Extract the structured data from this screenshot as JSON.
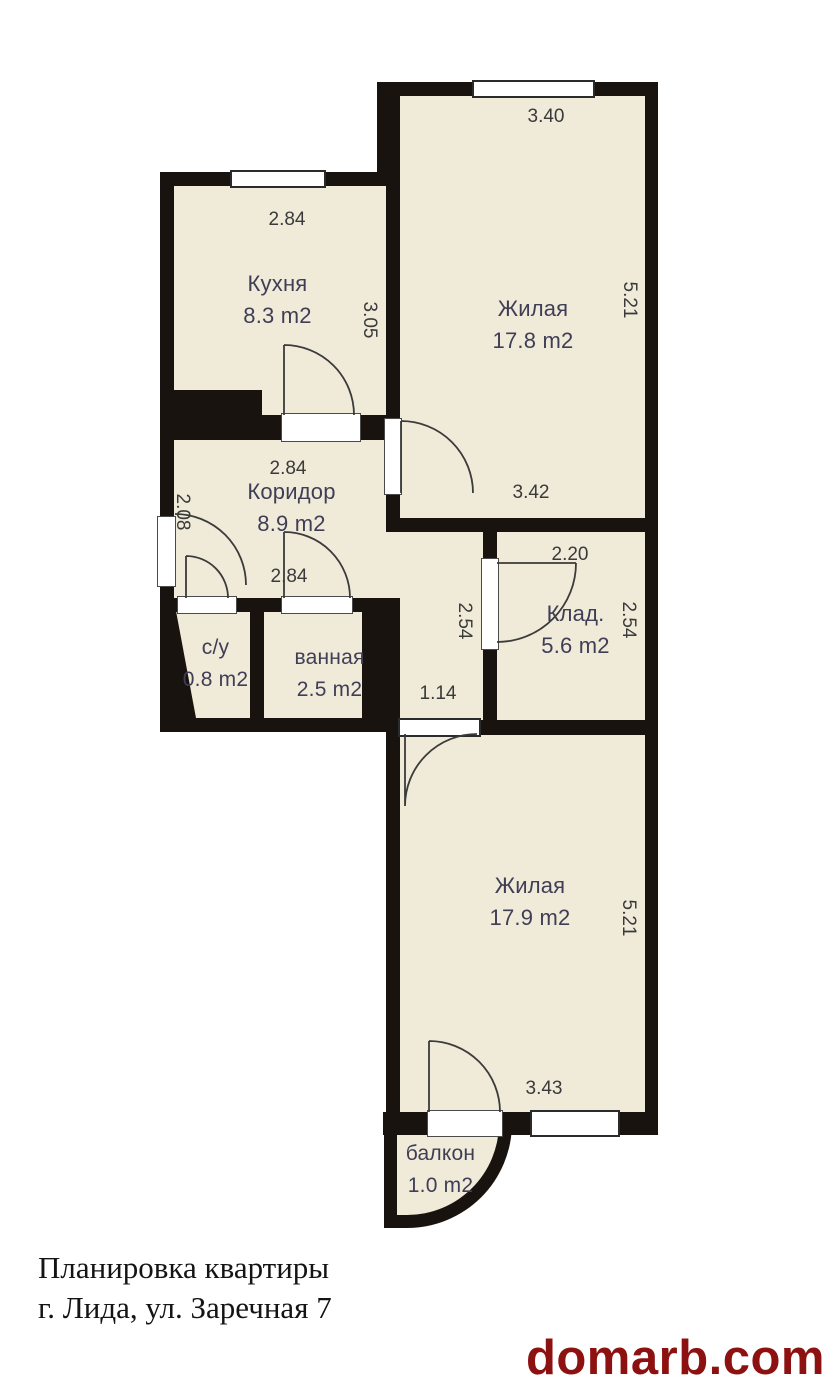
{
  "plan": {
    "rooms": [
      {
        "id": "kitchen",
        "name": "Кухня",
        "area": "8.3 m2"
      },
      {
        "id": "living1",
        "name": "Жилая",
        "area": "17.8 m2"
      },
      {
        "id": "corridor",
        "name": "Коридор",
        "area": "8.9 m2"
      },
      {
        "id": "wc",
        "name": "с/у",
        "area": "0.8 m2"
      },
      {
        "id": "bath",
        "name": "ванная",
        "area": "2.5 m2"
      },
      {
        "id": "storage",
        "name": "Клад.",
        "area": "5.6 m2"
      },
      {
        "id": "living2",
        "name": "Жилая",
        "area": "17.9 m2"
      },
      {
        "id": "balcony",
        "name": "балкон",
        "area": "1.0 m2"
      }
    ],
    "dims": {
      "living1_top": "3.40",
      "living1_right": "5.21",
      "living1_bottom": "3.42",
      "kitchen_top": "2.84",
      "kitchen_right": "3.05",
      "corridor_top": "2.84",
      "corridor_left": "2.08",
      "corridor_bottom": "2.84",
      "storage_top": "2.20",
      "storage_right": "2.54",
      "passage_height": "2.54",
      "passage_width": "1.14",
      "living2_right": "5.21",
      "living2_bottom": "3.43"
    },
    "caption": {
      "line1": "Планировка квартиры",
      "line2": "г. Лида, ул. Заречная 7"
    },
    "watermark": "domarb.com",
    "colors": {
      "room_fill": "#f0ead9",
      "wall": "#18130e",
      "room_label": "#3f3e56",
      "dimension_text": "#3a3a3a",
      "watermark_red": "#8d1111",
      "background": "#ffffff"
    }
  }
}
